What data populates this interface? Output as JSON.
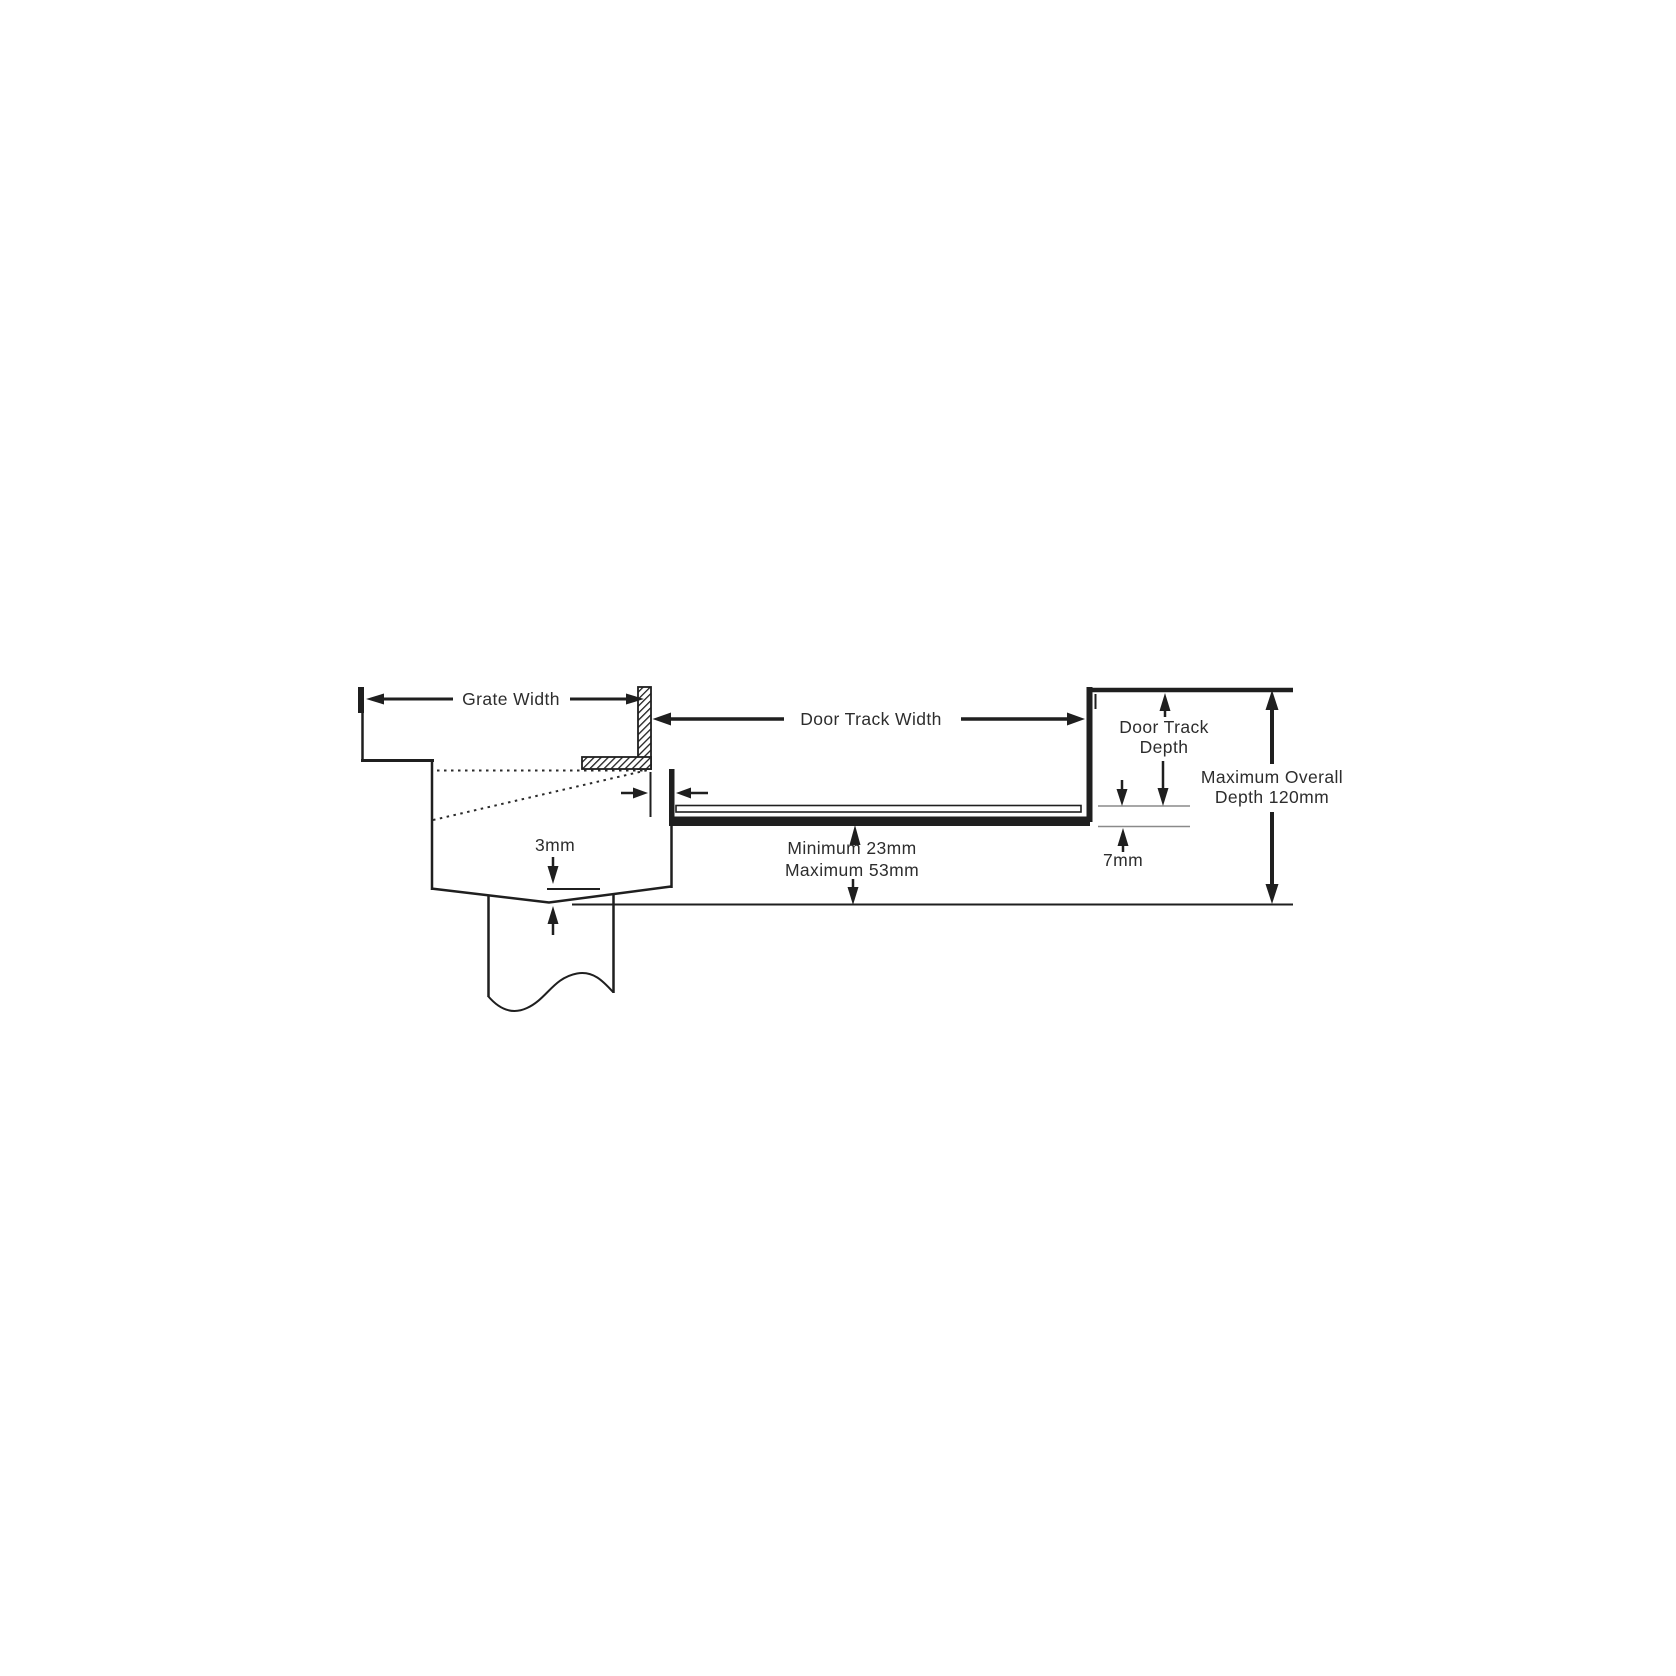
{
  "diagram": {
    "type": "technical-cross-section-drain-and-door-track",
    "labels": {
      "grate_width": "Grate Width",
      "door_track_width": "Door Track Width",
      "door_track_depth_l1": "Door Track",
      "door_track_depth_l2": "Depth",
      "max_overall_l1": "Maximum Overall",
      "max_overall_l2": "Depth 120mm",
      "clearance_min": "Minimum 23mm",
      "clearance_max": "Maximum 53mm",
      "invert_fall": "3mm",
      "track_height": "7mm"
    },
    "measurements": {
      "maximum_overall_depth_mm": 120,
      "clearance_min_mm": 23,
      "clearance_max_mm": 53,
      "track_upstand_mm": 7,
      "invert_fall_mm": 3
    },
    "colors": {
      "line": "#1f1f1f",
      "text": "#2d2d2d",
      "extension_line": "#8a8a8a",
      "background": "#ffffff"
    }
  }
}
